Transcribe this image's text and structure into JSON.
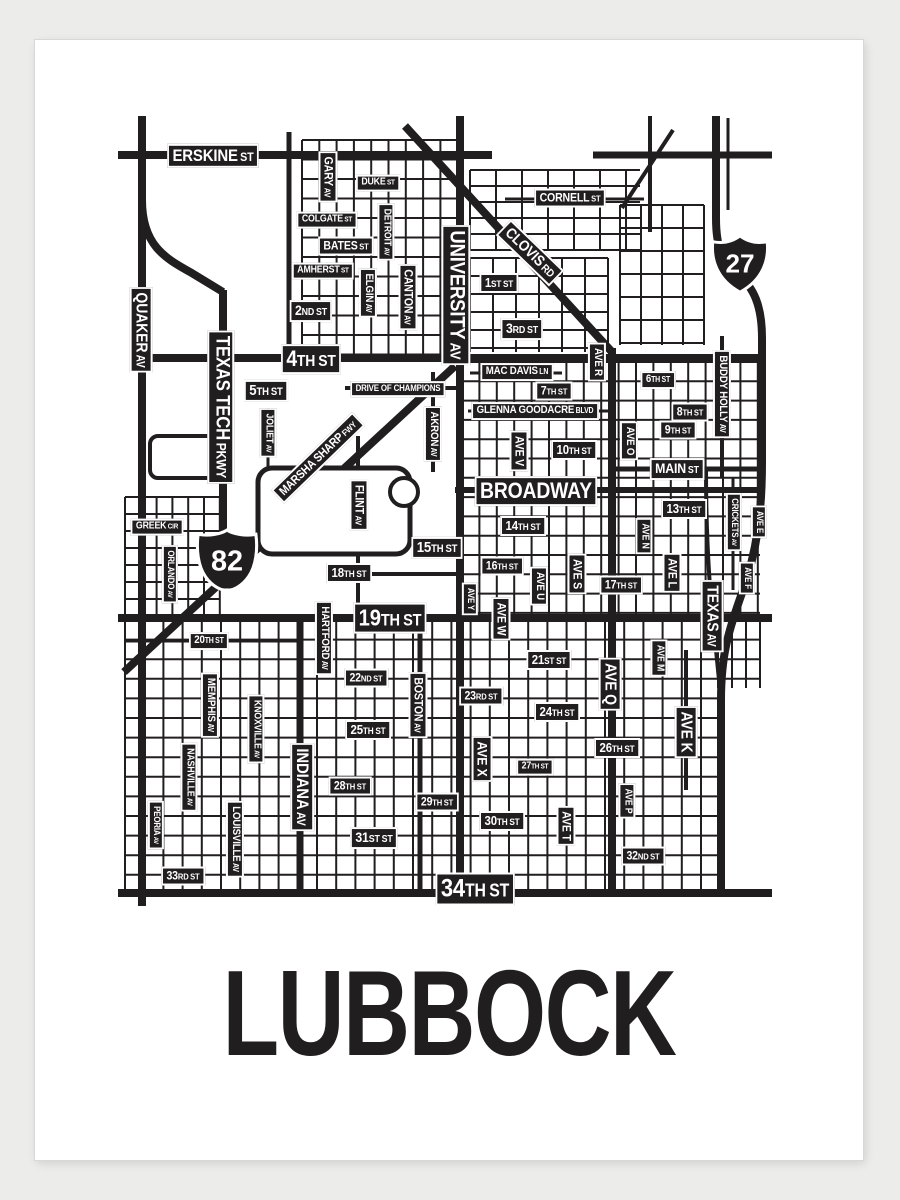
{
  "poster": {
    "title": "LUBBOCK"
  },
  "colors": {
    "ink": "#211e1f",
    "paper": "#ffffff",
    "page_background": "#ececea",
    "label_text": "#ffffff"
  },
  "shields": [
    {
      "kind": "interstate-shield",
      "number": "27",
      "x": 740,
      "y": 264
    },
    {
      "kind": "us-route-shield",
      "number": "82",
      "x": 227,
      "y": 560
    }
  ],
  "map": {
    "labels": [
      {
        "text": "ERSKINE ST",
        "main": "ERSKINE",
        "suffix": "ST",
        "x": 213,
        "y": 156,
        "fs": 17,
        "rot": 0
      },
      {
        "text": "DUKE ST",
        "main": "DUKE",
        "suffix": "ST",
        "x": 378,
        "y": 183,
        "fs": 10,
        "rot": 0
      },
      {
        "text": "COLGATE ST",
        "main": "COLGATE",
        "suffix": "ST",
        "x": 327,
        "y": 220,
        "fs": 10,
        "rot": 0
      },
      {
        "text": "BATES ST",
        "main": "BATES",
        "suffix": "ST",
        "x": 346,
        "y": 246,
        "fs": 12,
        "rot": 0
      },
      {
        "text": "AMHERST ST",
        "main": "AMHERST",
        "suffix": "ST",
        "x": 323,
        "y": 271,
        "fs": 10,
        "rot": 0
      },
      {
        "text": "2ND ST",
        "main": "2",
        "ord": "ND",
        "suffix": "ST",
        "x": 311,
        "y": 311,
        "fs": 14,
        "rot": 0
      },
      {
        "text": "CORNELL ST",
        "main": "CORNELL",
        "suffix": "ST",
        "x": 570,
        "y": 198,
        "fs": 12,
        "rot": 0
      },
      {
        "text": "1ST ST",
        "main": "1",
        "ord": "ST",
        "suffix": "ST",
        "x": 499,
        "y": 283,
        "fs": 13,
        "rot": 0
      },
      {
        "text": "3RD ST",
        "main": "3",
        "ord": "RD",
        "suffix": "ST",
        "x": 522,
        "y": 329,
        "fs": 14,
        "rot": 0
      },
      {
        "text": "4TH ST",
        "main": "4",
        "ord": "TH",
        "suffix": "ST",
        "x": 311,
        "y": 359,
        "fs": 22,
        "rot": 0
      },
      {
        "text": "5TH ST",
        "main": "5",
        "ord": "TH",
        "suffix": "ST",
        "x": 266,
        "y": 391,
        "fs": 15,
        "rot": 0
      },
      {
        "text": "DRIVE OF CHAMPIONS",
        "main": "DRIVE OF CHAMPIONS",
        "x": 398,
        "y": 389,
        "fs": 9,
        "rot": 0
      },
      {
        "text": "MAC DAVIS LN",
        "main": "MAC DAVIS",
        "suffix": "LN",
        "x": 517,
        "y": 372,
        "fs": 11,
        "rot": 0
      },
      {
        "text": "7TH ST",
        "main": "7",
        "ord": "TH",
        "suffix": "ST",
        "x": 554,
        "y": 391,
        "fs": 12,
        "rot": 0
      },
      {
        "text": "GLENNA GOODACRE BLVD",
        "main": "GLENNA GOODACRE",
        "suffix": "BLVD",
        "x": 535,
        "y": 411,
        "fs": 11,
        "rot": 0
      },
      {
        "text": "6TH ST",
        "main": "6",
        "ord": "TH",
        "suffix": "ST",
        "x": 658,
        "y": 380,
        "fs": 11,
        "rot": 0
      },
      {
        "text": "8TH ST",
        "main": "8",
        "ord": "TH",
        "suffix": "ST",
        "x": 690,
        "y": 412,
        "fs": 12,
        "rot": 0
      },
      {
        "text": "9TH ST",
        "main": "9",
        "ord": "TH",
        "suffix": "ST",
        "x": 678,
        "y": 430,
        "fs": 12,
        "rot": 0
      },
      {
        "text": "10TH ST",
        "main": "10",
        "ord": "TH",
        "suffix": "ST",
        "x": 574,
        "y": 450,
        "fs": 13,
        "rot": 0
      },
      {
        "text": "MAIN ST",
        "main": "MAIN",
        "suffix": "ST",
        "x": 677,
        "y": 469,
        "fs": 14,
        "rot": 0
      },
      {
        "text": "BROADWAY",
        "main": "BROADWAY",
        "x": 536,
        "y": 491,
        "fs": 22,
        "rot": 0
      },
      {
        "text": "13TH ST",
        "main": "13",
        "ord": "TH",
        "suffix": "ST",
        "x": 684,
        "y": 509,
        "fs": 13,
        "rot": 0
      },
      {
        "text": "14TH ST",
        "main": "14",
        "ord": "TH",
        "suffix": "ST",
        "x": 523,
        "y": 526,
        "fs": 13,
        "rot": 0
      },
      {
        "text": "15TH ST",
        "main": "15",
        "ord": "TH",
        "suffix": "ST",
        "x": 437,
        "y": 548,
        "fs": 15,
        "rot": 0
      },
      {
        "text": "16TH ST",
        "main": "16",
        "ord": "TH",
        "suffix": "ST",
        "x": 502,
        "y": 566,
        "fs": 12,
        "rot": 0
      },
      {
        "text": "17TH ST",
        "main": "17",
        "ord": "TH",
        "suffix": "ST",
        "x": 621,
        "y": 585,
        "fs": 12,
        "rot": 0
      },
      {
        "text": "18TH ST",
        "main": "18",
        "ord": "TH",
        "suffix": "ST",
        "x": 349,
        "y": 573,
        "fs": 13,
        "rot": 0
      },
      {
        "text": "19TH ST",
        "main": "19",
        "ord": "TH",
        "suffix": "ST",
        "x": 390,
        "y": 618,
        "fs": 23,
        "rot": 0
      },
      {
        "text": "GREEK CIR",
        "main": "GREEK",
        "suffix": "CIR",
        "x": 157,
        "y": 527,
        "fs": 10,
        "rot": 0
      },
      {
        "text": "20TH ST",
        "main": "20",
        "ord": "TH",
        "suffix": "ST",
        "x": 209,
        "y": 641,
        "fs": 11,
        "rot": 0
      },
      {
        "text": "21ST ST",
        "main": "21",
        "ord": "ST",
        "suffix": "ST",
        "x": 549,
        "y": 660,
        "fs": 13,
        "rot": 0
      },
      {
        "text": "22ND ST",
        "main": "22",
        "ord": "ND",
        "suffix": "ST",
        "x": 366,
        "y": 678,
        "fs": 12,
        "rot": 0
      },
      {
        "text": "23RD ST",
        "main": "23",
        "ord": "RD",
        "suffix": "ST",
        "x": 481,
        "y": 696,
        "fs": 12,
        "rot": 0
      },
      {
        "text": "24TH ST",
        "main": "24",
        "ord": "TH",
        "suffix": "ST",
        "x": 557,
        "y": 712,
        "fs": 13,
        "rot": 0
      },
      {
        "text": "25TH ST",
        "main": "25",
        "ord": "TH",
        "suffix": "ST",
        "x": 368,
        "y": 730,
        "fs": 13,
        "rot": 0
      },
      {
        "text": "26TH ST",
        "main": "26",
        "ord": "TH",
        "suffix": "ST",
        "x": 617,
        "y": 748,
        "fs": 13,
        "rot": 0
      },
      {
        "text": "27TH ST",
        "main": "27",
        "ord": "TH",
        "suffix": "ST",
        "x": 535,
        "y": 767,
        "fs": 10,
        "rot": 0
      },
      {
        "text": "28TH ST",
        "main": "28",
        "ord": "TH",
        "suffix": "ST",
        "x": 350,
        "y": 786,
        "fs": 12,
        "rot": 0
      },
      {
        "text": "29TH ST",
        "main": "29",
        "ord": "TH",
        "suffix": "ST",
        "x": 437,
        "y": 802,
        "fs": 12,
        "rot": 0
      },
      {
        "text": "30TH ST",
        "main": "30",
        "ord": "TH",
        "suffix": "ST",
        "x": 502,
        "y": 821,
        "fs": 13,
        "rot": 0
      },
      {
        "text": "31ST ST",
        "main": "31",
        "ord": "ST",
        "suffix": "ST",
        "x": 374,
        "y": 838,
        "fs": 14,
        "rot": 0
      },
      {
        "text": "32ND ST",
        "main": "32",
        "ord": "ND",
        "suffix": "ST",
        "x": 643,
        "y": 856,
        "fs": 12,
        "rot": 0
      },
      {
        "text": "33RD ST",
        "main": "33",
        "ord": "RD",
        "suffix": "ST",
        "x": 183,
        "y": 876,
        "fs": 12,
        "rot": 0
      },
      {
        "text": "34TH ST",
        "main": "34",
        "ord": "TH",
        "suffix": "ST",
        "x": 475,
        "y": 889,
        "fs": 25,
        "rot": 0
      },
      {
        "text": "QUAKER AV",
        "main": "QUAKER",
        "suffix": "AV",
        "x": 141,
        "y": 330,
        "fs": 16,
        "rot": 90
      },
      {
        "text": "GARY AV",
        "main": "GARY",
        "suffix": "AV",
        "x": 328,
        "y": 177,
        "fs": 12,
        "rot": 90
      },
      {
        "text": "DETROIT AV",
        "main": "DETROIT",
        "suffix": "AV",
        "x": 386,
        "y": 232,
        "fs": 10,
        "rot": 90
      },
      {
        "text": "CANTON AV",
        "main": "CANTON",
        "suffix": "AV",
        "x": 408,
        "y": 297,
        "fs": 12,
        "rot": 90
      },
      {
        "text": "ELGIN AV",
        "main": "ELGIN",
        "suffix": "AV",
        "x": 368,
        "y": 293,
        "fs": 11,
        "rot": 90
      },
      {
        "text": "UNIVERSITY AV",
        "main": "UNIVERSITY",
        "suffix": "AV",
        "x": 456,
        "y": 295,
        "fs": 21,
        "rot": 90
      },
      {
        "text": "TEXAS TECH PKWY",
        "main": "TEXAS TECH",
        "suffix": "PKWY",
        "x": 221,
        "y": 407,
        "fs": 19,
        "rot": 90
      },
      {
        "text": "JOLIET AV",
        "main": "JOLIET",
        "suffix": "AV",
        "x": 268,
        "y": 433,
        "fs": 10,
        "rot": 90
      },
      {
        "text": "AKRON AV",
        "main": "AKRON",
        "suffix": "AV",
        "x": 433,
        "y": 434,
        "fs": 11,
        "rot": 90
      },
      {
        "text": "AVE V",
        "main": "AVE V",
        "x": 519,
        "y": 451,
        "fs": 12,
        "rot": 90
      },
      {
        "text": "AVE R",
        "main": "AVE R",
        "x": 597,
        "y": 362,
        "fs": 11,
        "rot": 90
      },
      {
        "text": "AVE O",
        "main": "AVE O",
        "x": 629,
        "y": 441,
        "fs": 11,
        "rot": 90
      },
      {
        "text": "BUDDY HOLLY AV",
        "main": "BUDDY HOLLY",
        "suffix": "AV",
        "x": 722,
        "y": 394,
        "fs": 11,
        "rot": 90
      },
      {
        "text": "CRICKETS AV",
        "main": "CRICKETS",
        "suffix": "AV",
        "x": 734,
        "y": 522,
        "fs": 9,
        "rot": 90
      },
      {
        "text": "AVE E",
        "main": "AVE E",
        "x": 759,
        "y": 522,
        "fs": 9,
        "rot": 90
      },
      {
        "text": "AVE F",
        "main": "AVE F",
        "x": 747,
        "y": 578,
        "fs": 9,
        "rot": 90
      },
      {
        "text": "FLINT AV",
        "main": "FLINT",
        "suffix": "AV",
        "x": 359,
        "y": 505,
        "fs": 12,
        "rot": 90
      },
      {
        "text": "AVE Y",
        "main": "AVE Y",
        "x": 470,
        "y": 599,
        "fs": 9,
        "rot": 90
      },
      {
        "text": "AVE W",
        "main": "AVE W",
        "x": 501,
        "y": 619,
        "fs": 12,
        "rot": 90
      },
      {
        "text": "AVE U",
        "main": "AVE U",
        "x": 539,
        "y": 586,
        "fs": 11,
        "rot": 90
      },
      {
        "text": "AVE S",
        "main": "AVE S",
        "x": 577,
        "y": 574,
        "fs": 12,
        "rot": 90
      },
      {
        "text": "AVE N",
        "main": "AVE N",
        "x": 644,
        "y": 536,
        "fs": 10,
        "rot": 90
      },
      {
        "text": "AVE L",
        "main": "AVE L",
        "x": 672,
        "y": 573,
        "fs": 12,
        "rot": 90
      },
      {
        "text": "TEXAS AV",
        "main": "TEXAS",
        "suffix": "AV",
        "x": 712,
        "y": 616,
        "fs": 16,
        "rot": 90
      },
      {
        "text": "HARTFORD AV",
        "main": "HARTFORD",
        "suffix": "AV",
        "x": 324,
        "y": 638,
        "fs": 11,
        "rot": 90
      },
      {
        "text": "MEMPHIS AV",
        "main": "MEMPHIS",
        "suffix": "AV",
        "x": 210,
        "y": 705,
        "fs": 11,
        "rot": 90
      },
      {
        "text": "KNOXVILLE AV",
        "main": "KNOXVILLE",
        "suffix": "AV",
        "x": 256,
        "y": 729,
        "fs": 10,
        "rot": 90
      },
      {
        "text": "NASHVILLE AV",
        "main": "NASHVILLE",
        "suffix": "AV",
        "x": 189,
        "y": 777,
        "fs": 10,
        "rot": 90
      },
      {
        "text": "ORLANDO AV",
        "main": "ORLANDO",
        "suffix": "AV",
        "x": 170,
        "y": 574,
        "fs": 9,
        "rot": 90
      },
      {
        "text": "BOSTON AV",
        "main": "BOSTON",
        "suffix": "AV",
        "x": 418,
        "y": 705,
        "fs": 12,
        "rot": 90
      },
      {
        "text": "AVE X",
        "main": "AVE X",
        "x": 482,
        "y": 759,
        "fs": 14,
        "rot": 90
      },
      {
        "text": "AVE Q",
        "main": "AVE Q",
        "x": 610,
        "y": 684,
        "fs": 16,
        "rot": 90
      },
      {
        "text": "AVE M",
        "main": "AVE M",
        "x": 659,
        "y": 658,
        "fs": 10,
        "rot": 90
      },
      {
        "text": "AVE K",
        "main": "AVE K",
        "x": 686,
        "y": 732,
        "fs": 16,
        "rot": 90
      },
      {
        "text": "INDIANA AV",
        "main": "INDIANA",
        "suffix": "AV",
        "x": 302,
        "y": 787,
        "fs": 17,
        "rot": 90
      },
      {
        "text": "PEORIA AV",
        "main": "PEORIA",
        "suffix": "AV",
        "x": 156,
        "y": 825,
        "fs": 9,
        "rot": 90
      },
      {
        "text": "LOUISVILLE AV",
        "main": "LOUISVILLE",
        "suffix": "AV",
        "x": 235,
        "y": 839,
        "fs": 11,
        "rot": 90
      },
      {
        "text": "AVE T",
        "main": "AVE T",
        "x": 566,
        "y": 826,
        "fs": 12,
        "rot": 90
      },
      {
        "text": "AVE P",
        "main": "AVE P",
        "x": 627,
        "y": 801,
        "fs": 10,
        "rot": 90
      },
      {
        "text": "CLOVIS RD",
        "main": "CLOVIS",
        "suffix": "RD",
        "x": 530,
        "y": 253,
        "fs": 15,
        "rot": 44
      },
      {
        "text": "MARSHA SHARP FWY",
        "main": "MARSHA SHARP",
        "suffix": "FWY",
        "x": 318,
        "y": 458,
        "fs": 12,
        "rot": -44
      }
    ]
  }
}
